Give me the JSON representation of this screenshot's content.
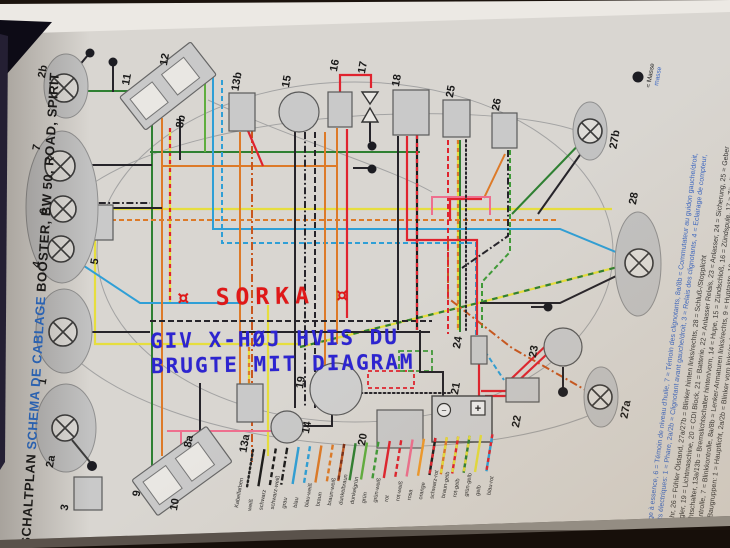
{
  "title": {
    "part1_black": "SCHALTPLAN ",
    "part2_blue": "SCHEMA DE CABLAGE ",
    "part3_black": "BOOSTER, BW 50, ROAD, SPIRIT",
    "blue_color": "#2a6fd0"
  },
  "overlay": {
    "red_text": "¤ SORKA ¤",
    "red_color": "#e01818",
    "blue_line1": "GIV X-HØJ HVIS DU",
    "blue_line2": "BRUGTE MIT DIAGRAM",
    "blue_color": "#2d24d0"
  },
  "masse": {
    "label_de": "= Masse",
    "label_fr": "masse",
    "fr_color": "#3a66c2"
  },
  "battery": {
    "minus": "−",
    "plus": "+"
  },
  "components": {
    "c1": "1",
    "c2a": "2a",
    "c2b": "2b",
    "c3": "3",
    "c4": "4",
    "c5": "5",
    "c6": "6",
    "c7": "7",
    "c8a": "8a",
    "c8b": "8b",
    "c9": "9",
    "c10": "10",
    "c11": "11",
    "c12": "12",
    "c13a": "13a",
    "c13b": "13b",
    "c14": "14",
    "c15": "15",
    "c16": "16",
    "c17": "17",
    "c18": "18",
    "c19": "19",
    "c20": "20",
    "c21": "21",
    "c22": "22",
    "c23": "23",
    "c24": "24",
    "c25": "25",
    "c26": "26",
    "c27a": "27a",
    "c27b": "27b",
    "c28": "28"
  },
  "legend": {
    "header": "Kabelfarben",
    "items": [
      {
        "label": "weiß",
        "pattern": "dotted",
        "colors": [
          "#222222"
        ]
      },
      {
        "label": "schwarz",
        "pattern": "solid",
        "colors": [
          "#1c1c1c"
        ]
      },
      {
        "label": "schwarz-weiß",
        "pattern": "dashed",
        "colors": [
          "#1c1c1c"
        ]
      },
      {
        "label": "grau",
        "pattern": "dashdot",
        "colors": [
          "#1c1c1c"
        ]
      },
      {
        "label": "blau",
        "pattern": "solid",
        "colors": [
          "#2f9fd6"
        ]
      },
      {
        "label": "blau-weiß",
        "pattern": "dashed",
        "colors": [
          "#2f9fd6"
        ]
      },
      {
        "label": "braun",
        "pattern": "solid",
        "colors": [
          "#dd7a28"
        ]
      },
      {
        "label": "braun-weiß",
        "pattern": "dashed",
        "colors": [
          "#dd7a28"
        ]
      },
      {
        "label": "dunkelbraun",
        "pattern": "twotone",
        "colors": [
          "#c05a24",
          "#7a3018"
        ]
      },
      {
        "label": "dunkelgrün",
        "pattern": "solid",
        "colors": [
          "#2f8032"
        ]
      },
      {
        "label": "grün",
        "pattern": "solid",
        "colors": [
          "#5fae3f"
        ]
      },
      {
        "label": "grün-weiß",
        "pattern": "dashed",
        "colors": [
          "#3f9a38"
        ]
      },
      {
        "label": "rot",
        "pattern": "solid",
        "colors": [
          "#e0232e"
        ]
      },
      {
        "label": "rot-weiß",
        "pattern": "dashed",
        "colors": [
          "#e0232e"
        ]
      },
      {
        "label": "rosa",
        "pattern": "solid",
        "colors": [
          "#ee6f8e"
        ]
      },
      {
        "label": "orange",
        "pattern": "solid",
        "colors": [
          "#f09a2c"
        ]
      },
      {
        "label": "schwarz-rot",
        "pattern": "twotone",
        "colors": [
          "#1c1c1c",
          "#e0232e"
        ]
      },
      {
        "label": "braun-gelb",
        "pattern": "twotone",
        "colors": [
          "#dd7a28",
          "#e6de3e"
        ]
      },
      {
        "label": "rot-gelb",
        "pattern": "twotone",
        "colors": [
          "#e0232e",
          "#e6de3e"
        ]
      },
      {
        "label": "grün-gelb",
        "pattern": "twotone",
        "colors": [
          "#2f8032",
          "#e6de3e"
        ]
      },
      {
        "label": "gelb",
        "pattern": "solid",
        "colors": [
          "#e6de3e"
        ]
      },
      {
        "label": "blau-rot",
        "pattern": "twotone",
        "colors": [
          "#2f9fd6",
          "#e0232e"
        ]
      }
    ]
  },
  "description": {
    "german_color": "#333333",
    "french_color": "#3a66c2",
    "german_lines": [
      "Elektrik-Baugruppen: 1 = Hauptlicht, 2a/2b = Blinker vorn links/rechts, 3 = Blinkrelais, 4 = Cockpit-Beleuchtung, 5 = Benzinuhr,",
      "6 = Ölkontrolle, 7 = Blinkkontrolle, 8a/8b = Lenker-Armaturen links/rechts, 9 = Huptaste, 10 = Blinkschalter, 11 = Startertaste,",
      "12 = Lichtschalter, 13a/13b = Bremslichtschalter hinten/vorn, 14 = Hupe, 15 = Zündschloß, 16 = Zündspule, 17 = Zündkerze,",
      "18 = Regler, 19 = Lichtmaschine, 20 = CDI Block, 21 = Batterie, 22 = Anlasser Relais, 23 = Anlasser, 24 = Sicherung, 25 = Geber",
      "Benzinuhr, 26 = Fühler Ölstand, 27a/27b = Blinker hinten links/rechts, 28 = Schluß-/Stopplicht"
    ],
    "french_lines": [
      "Éléments électriques: 1 = Phare, 2a/2b = Clignotant avant gauche/droit, 3 = Relais des clignotants, 4 = Eclairage de compteur,",
      "5 = Jauge à essence, 6 = Témoin de niveau d'huile, 7 = Témoin des clignotants, 8a/8b = Commutateur au guidon gauche/droit,",
      "9 ="
    ]
  }
}
